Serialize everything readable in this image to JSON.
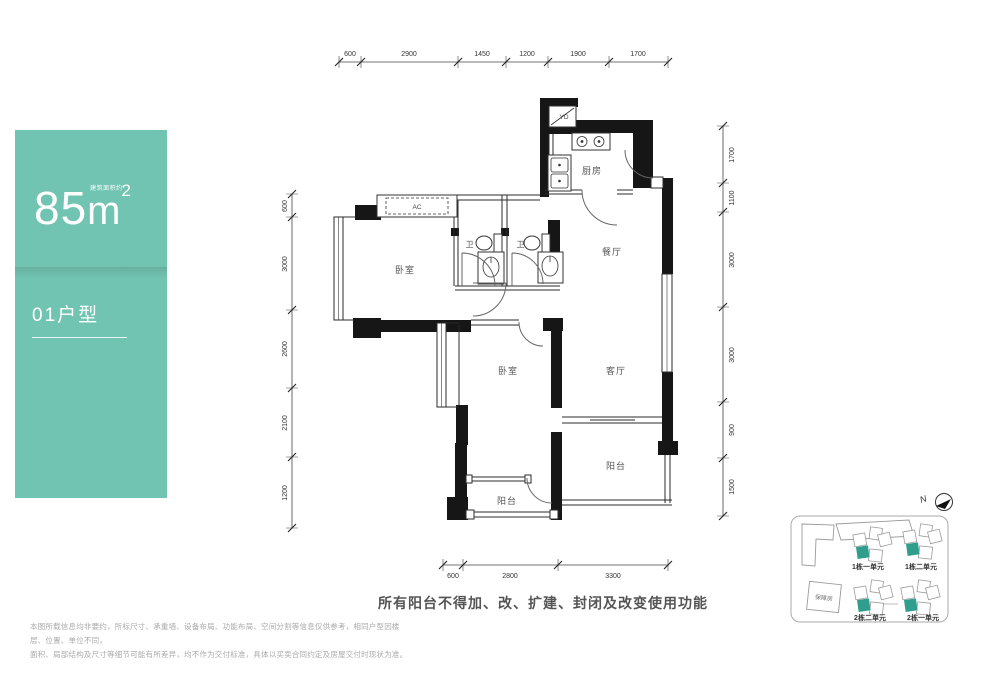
{
  "card": {
    "area_value": "85",
    "area_unit": "m",
    "area_sup": "2",
    "area_note": "建筑面积约",
    "unit_name": "01户型"
  },
  "plan": {
    "rooms": {
      "kitchen": "厨房",
      "dining": "餐厅",
      "living": "客厅",
      "bedroom1": "卧室",
      "bedroom2": "卧室",
      "bath1": "卫",
      "bath2": "卫",
      "balcony_right": "阳台",
      "balcony_left": "阳台",
      "ac": "AC",
      "yd": "YD"
    },
    "dims_top": [
      "600",
      "2900",
      "1450",
      "1200",
      "1900",
      "1700"
    ],
    "dims_left": [
      "600",
      "3000",
      "2600",
      "2100",
      "1200"
    ],
    "dims_right": [
      "1700",
      "1100",
      "3000",
      "3000",
      "900",
      "1500"
    ],
    "dims_bottom": [
      "600",
      "2800",
      "3300"
    ]
  },
  "sitemap": {
    "north": "N",
    "affordable": "保障房",
    "units": [
      "1栋一单元",
      "1栋二单元",
      "2栋二单元",
      "2栋一单元"
    ]
  },
  "notes": {
    "balcony_warning": "所有阳台不得加、改、扩建、封闭及改变使用功能",
    "disclaimer_line1": "本图所载信息均非要约，所标尺寸、承重墙、设备布局、功能布局、空间分割等信息仅供参考，相同户型因楼层、位置、单位不同，",
    "disclaimer_line2": "面积、局部结构及尺寸等细节可能有所差异，均不作为交付标准，具体以买卖合同约定及房屋交付时现状为准。"
  },
  "colors": {
    "card_teal": "#72c4b2",
    "map_highlight": "#2f9e8d",
    "wall_black": "#161616"
  }
}
